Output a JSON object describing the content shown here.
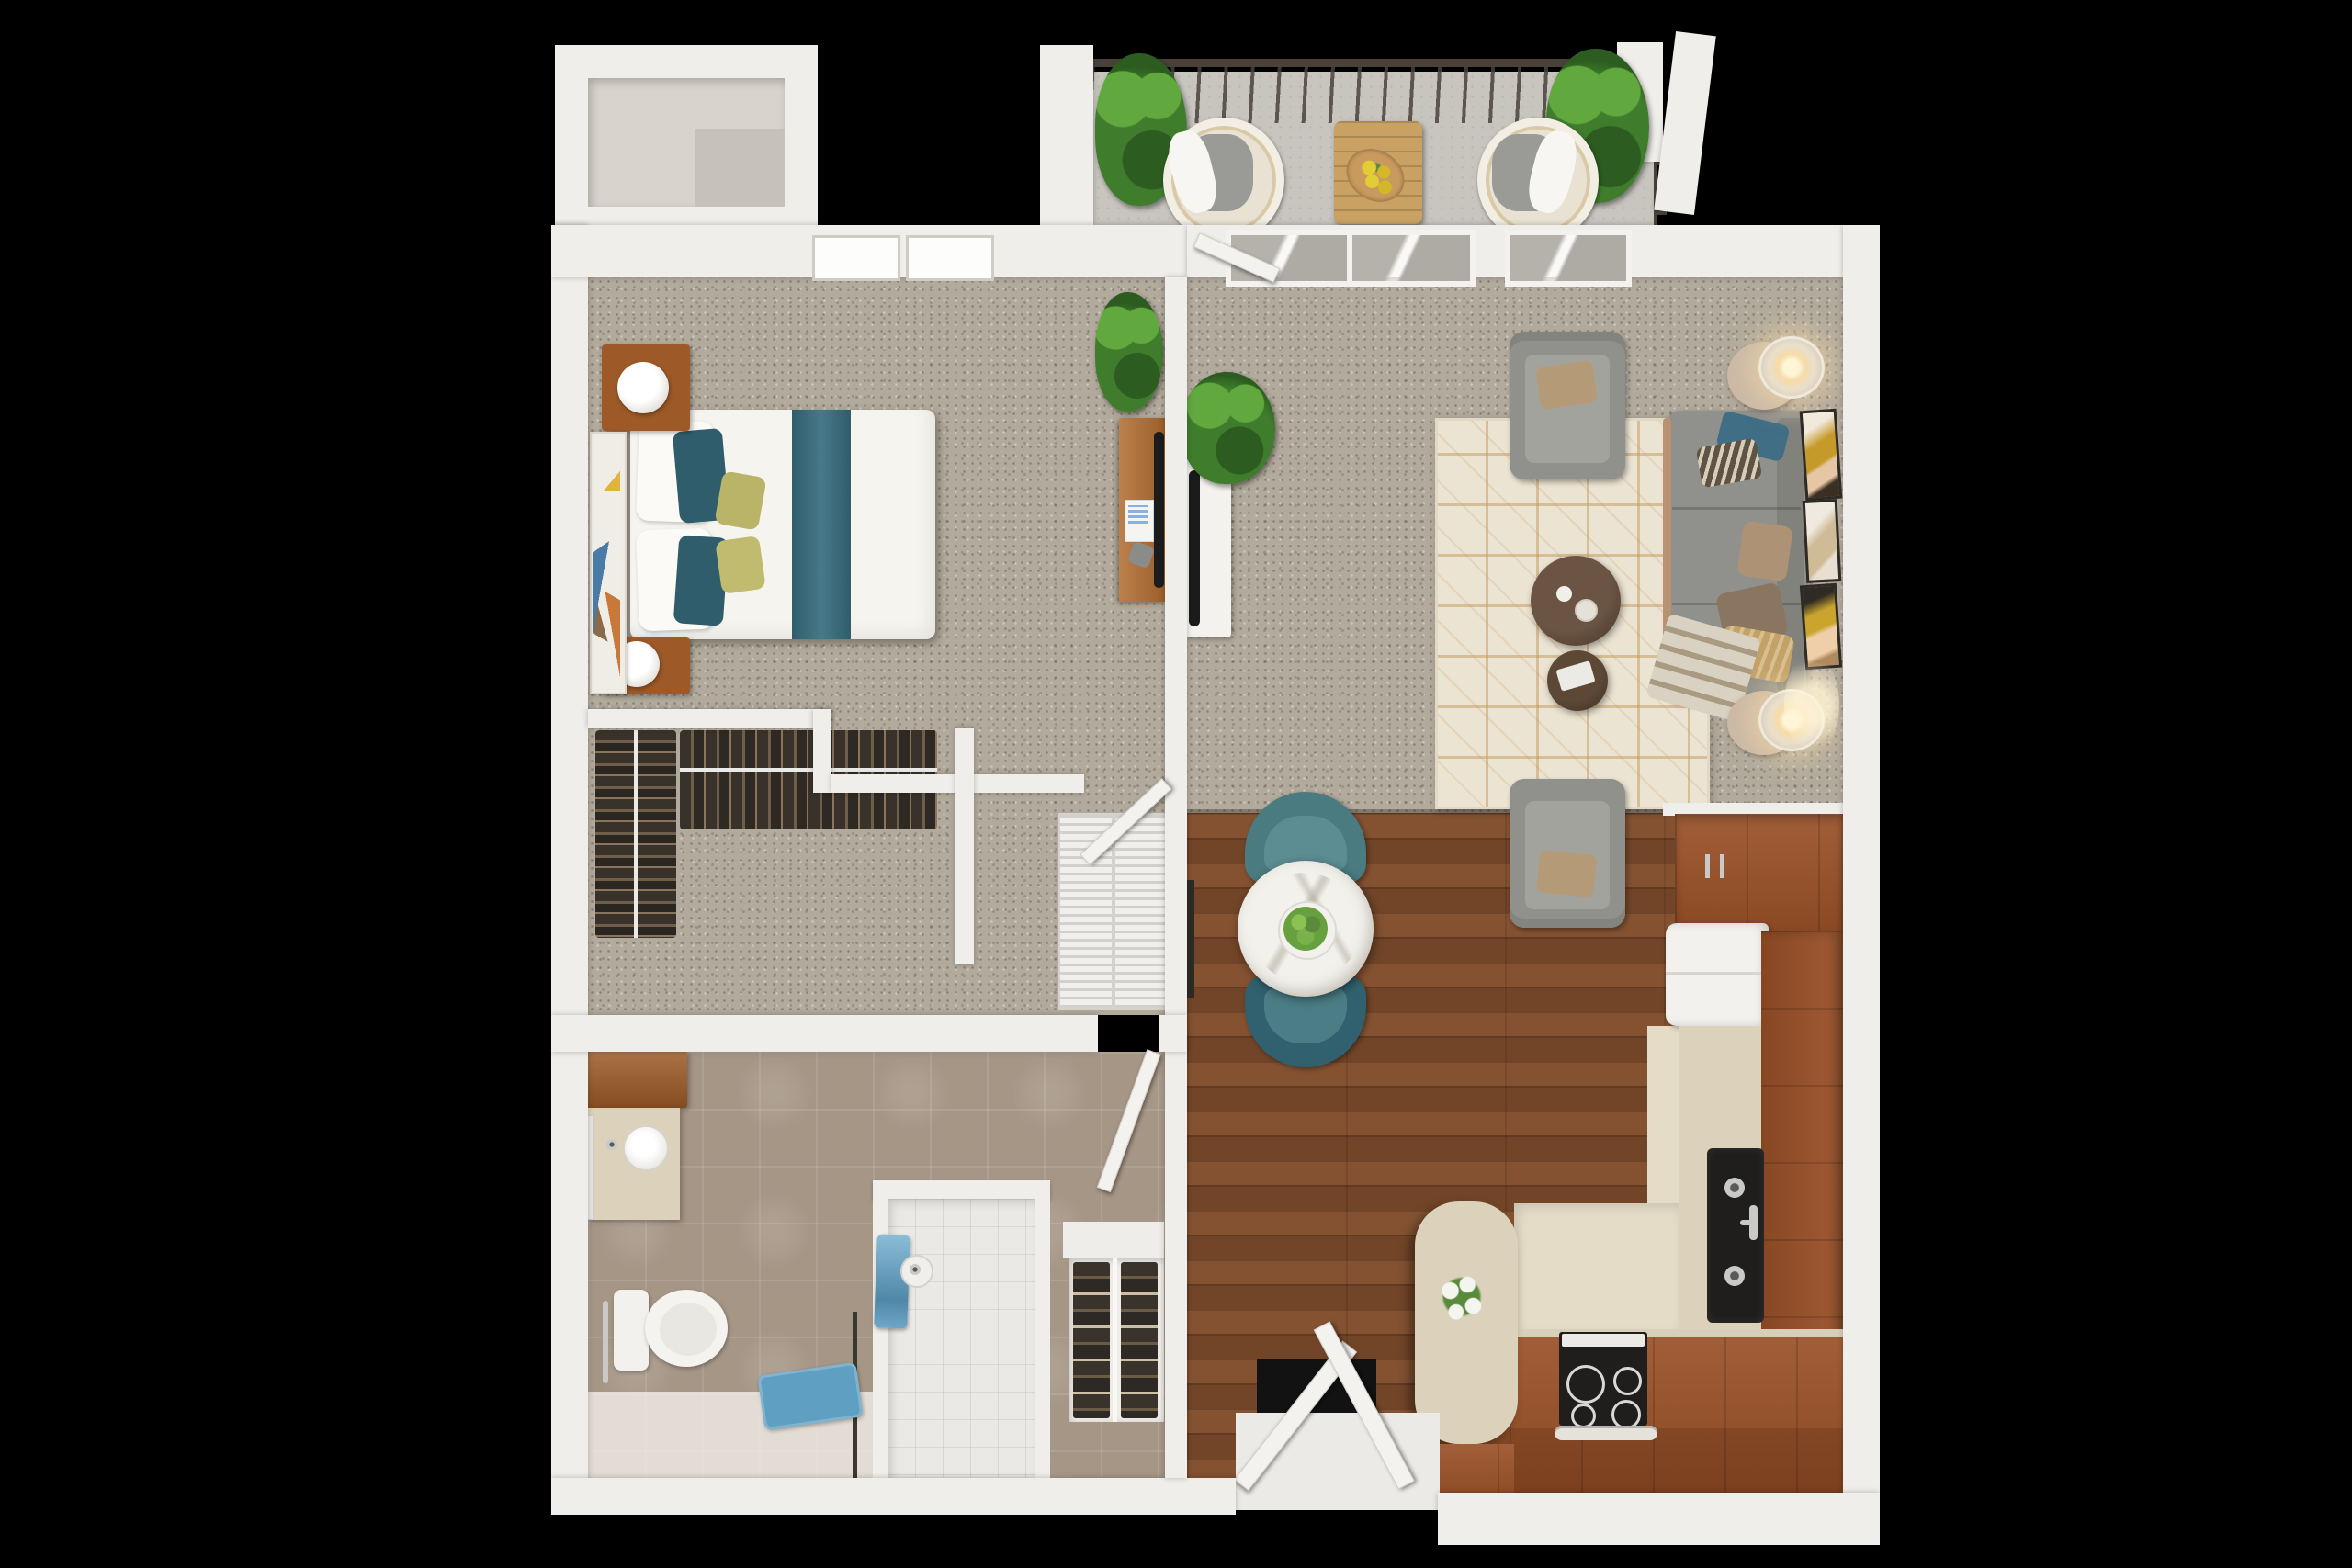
{
  "meta": {
    "type": "3d-floor-plan-render",
    "view": "top-down",
    "visible_text": "none"
  },
  "palette": {
    "background": "#000000",
    "wall": "#f0eeea",
    "wall_shadow": "#d9d6d0",
    "carpet": "#b2aa9c",
    "wood_floor": "#7b4a2b",
    "cabinet_wood": "#9a5128",
    "countertop": "#dcd2bb",
    "kitchen_floor": "#e5dcc7",
    "tile_bath": "#a69686",
    "tile_shower": "#ebe9e5",
    "concrete": "#c8c5bf",
    "rug": "#ece4d2",
    "rug_line": "#c59e66",
    "sofa": "#90908c",
    "teal": "#4a7b81",
    "teal_dark": "#31616e",
    "bed_white": "#f6f4ef",
    "headboard": "#9b968e",
    "nightstand": "#9d5a28",
    "glow": "#f6dba6",
    "plant": "#3f7d2d",
    "plant_light": "#61a83f",
    "towel": "#6fa7c8",
    "mat": "#5f9fc2",
    "black_appliance": "#1f1e1c",
    "chrome": "#c9c9c7",
    "marble": "#edece7",
    "dark_rail": "#4a423a",
    "clothes": "#39322a",
    "clothes_light": "#6e5e4a",
    "shelf_tan": "#cdbfa5",
    "door": "#f4f2ee",
    "table_wood": "#c9a163",
    "flower_yellow": "#e3cc35"
  },
  "rooms": {
    "balcony": {
      "items": [
        "railing",
        "corner-posts",
        "potted-plant-left",
        "potted-plant-right",
        "wicker-chair-left",
        "wicker-chair-right",
        "outdoor-table",
        "yellow-flower-bowl",
        "concrete-floor"
      ]
    },
    "bedroom": {
      "items": [
        "queen-bed",
        "teal-bed-runner",
        "accent-pillows",
        "headboard",
        "nightstand-top",
        "nightstand-bottom",
        "table-lamps",
        "wall-art",
        "desk",
        "desk-monitor",
        "plant",
        "ceiling-lights",
        "door-to-hall"
      ]
    },
    "walk_in_closet": {
      "items": [
        "hanging-clothes-left-rod",
        "hanging-clothes-top-rod"
      ]
    },
    "laundry_nook": {
      "items": [
        "washer-louver-unit",
        "dryer-louver-unit"
      ]
    },
    "bathroom": {
      "items": [
        "vanity-cabinet",
        "round-sink",
        "mirror",
        "toilet",
        "grab-bar",
        "shower",
        "shower-head",
        "towel-blue",
        "bath-mat-blue",
        "shoe-shelf",
        "bathroom-door"
      ]
    },
    "living_room": {
      "items": [
        "patterned-rug",
        "armchair-top",
        "armchair-bottom",
        "sofa",
        "throw-pillows",
        "plaid-throw",
        "coffee-table-large",
        "coffee-table-small",
        "floor-lamp-top",
        "floor-lamp-bottom",
        "tv-console",
        "tv",
        "art-frames-x3",
        "plant",
        "sliding-glass-doors"
      ]
    },
    "dining": {
      "items": [
        "round-marble-table",
        "center-plant",
        "teal-chair-top",
        "teal-chair-bottom",
        "wall-shelf"
      ]
    },
    "kitchen": {
      "items": [
        "upper-cabinets",
        "refrigerator",
        "counter-right",
        "double-basin-sink",
        "faucet",
        "island-with-flowers",
        "bottom-counter",
        "range-stove",
        "oven-handle",
        "cream-aisle-floor"
      ]
    },
    "entry": {
      "items": [
        "double-entry-doors",
        "threshold",
        "door-opening"
      ]
    }
  }
}
